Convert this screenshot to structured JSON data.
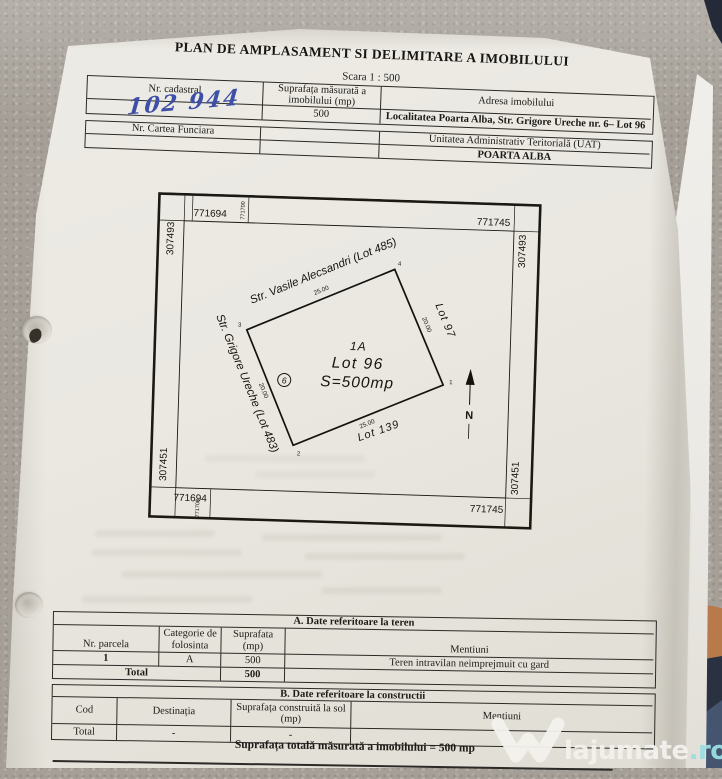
{
  "document": {
    "title": "PLAN DE AMPLASAMENT SI DELIMITARE A IMOBILULUI",
    "scale_note": "Scara 1 : 500",
    "id_table": {
      "col1_header": "Nr. cadastral",
      "col2_header": "Suprafața măsurată a imobilului (mp)",
      "col3_header": "Adresa imobilului",
      "nr_cadastral_handwritten": "102 944",
      "suprafata_mp": "500",
      "adresa": "Localitatea Poarta Alba, Str. Grigore Ureche nr. 6– Lot 96"
    },
    "cf_table": {
      "col1_header": "Nr. Cartea Funciara",
      "uat_header": "Unitatea Administrativ Teritorială (UAT)",
      "uat_value": "POARTA ALBA"
    }
  },
  "plan": {
    "grid": {
      "top_left": "771694",
      "top_left_minor": "771700",
      "top_right": "771745",
      "bottom_left": "771694",
      "bottom_left_minor": "771700",
      "bottom_right": "771745",
      "left_top": "307493",
      "left_bottom": "307451",
      "right_top": "307493",
      "right_bottom": "307451"
    },
    "parcel": {
      "label_id": "1A",
      "label_lot": "Lot 96",
      "label_area": "S=500mp",
      "interior_marker": "6",
      "dim_top": "25.00",
      "dim_right": "20.00",
      "dim_bottom": "25.00",
      "dim_left": "20.00",
      "corner_1": "1",
      "corner_2": "2",
      "corner_3": "3",
      "corner_4": "4"
    },
    "adjacent": {
      "north_west_street": "Str. Vasile Alecsandri (Lot 485)",
      "north_east_lot": "Lot 97",
      "south_east_lot": "Lot 139",
      "south_west_street": "Str. Grigore Ureche (Lot 483)"
    },
    "north_label": "N"
  },
  "table_a": {
    "title": "A. Date referitoare la teren",
    "headers": [
      "Nr. parcela",
      "Categorie de folosinta",
      "Suprafata (mp)",
      "Mentiuni"
    ],
    "rows": [
      [
        "1",
        "A",
        "500",
        "Teren intravilan neimprejmuit cu gard"
      ]
    ],
    "total_label": "Total",
    "total_value": "500"
  },
  "table_b": {
    "title": "B. Date referitoare la constructii",
    "headers": [
      "Cod",
      "Destinația",
      "Suprafața construită la sol (mp)",
      "Mentiuni"
    ],
    "total_label": "Total",
    "total_destinatia": "-",
    "total_suprafata": "-"
  },
  "footer": {
    "total_line": "Suprafața totală măsurată a imobilului = 500 mp"
  },
  "watermark": {
    "brand": "lajumate",
    "tld": ".ro",
    "brand_color": "#f4f2ee",
    "tld_color": "#9adfe2"
  }
}
